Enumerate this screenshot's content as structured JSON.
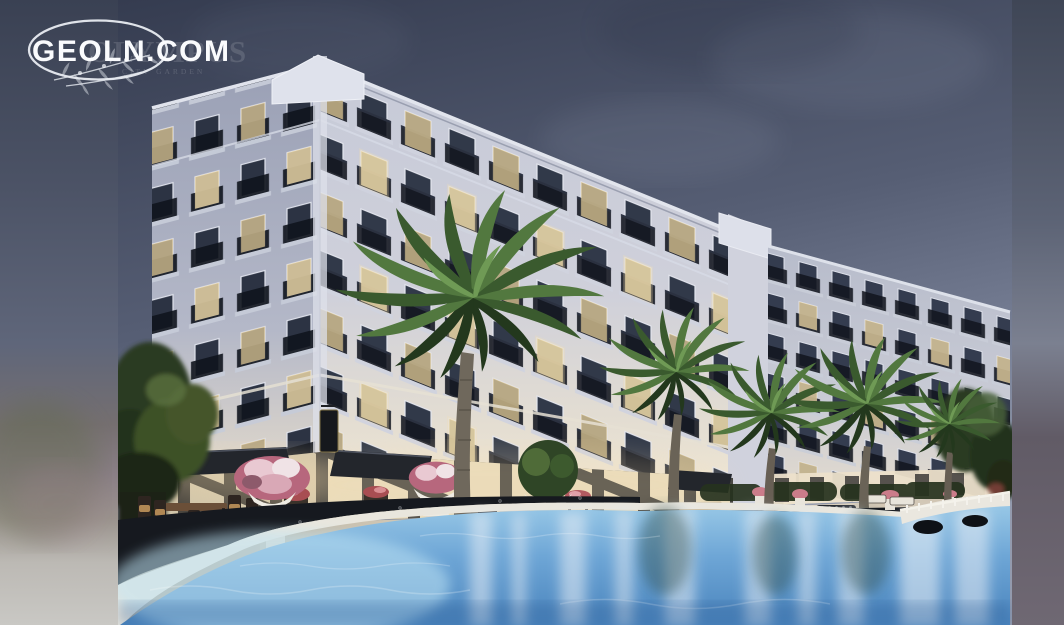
{
  "watermark": {
    "brand": "GEOLN.COM",
    "ghost_title": "OLYMPUS",
    "ghost_subtitle": "CITY GARDEN"
  },
  "scene": {
    "type": "architectural-render-photo",
    "subject": "Neoclassical residential complex at dusk with palm trees, outdoor cafe terrace and swimming pool",
    "colors": {
      "sky_top": "#353c50",
      "sky_bottom": "#939aad",
      "facade_light": "#f4ead6",
      "facade_shaded": "#9aa0b5",
      "window_lit": "#f3dfad",
      "window_dark": "#313949",
      "iron_railing": "#12161f",
      "awning": "#23262c",
      "walkway": "#16191f",
      "pool_shallow": "#9ccbe8",
      "pool_deep": "#4a84bd",
      "deck": "#e7ddc8",
      "foliage": "#2c3a22",
      "flowers": "#d9a8b6",
      "letterbox_left_top": "#3a4153",
      "letterbox_right_top": "#3f4656"
    }
  }
}
